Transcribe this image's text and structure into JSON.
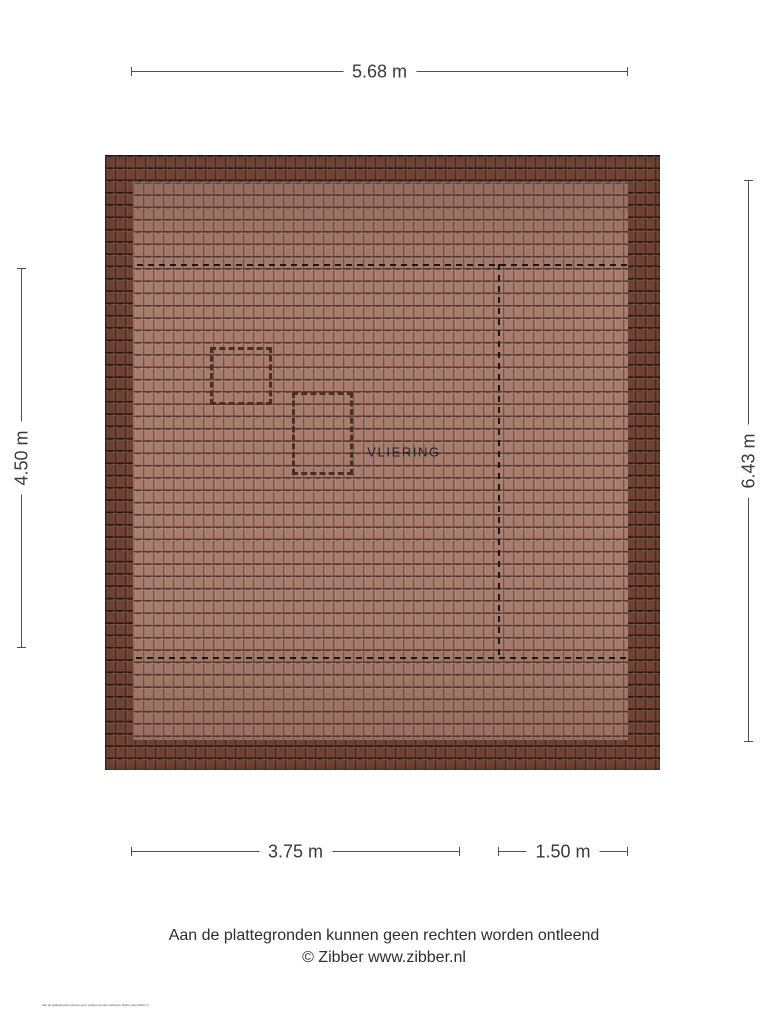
{
  "plan": {
    "room_label": "VLIERING",
    "dimensions": {
      "top": "5.68 m",
      "left": "4.50 m",
      "right": "6.43 m",
      "bottom_left": "3.75 m",
      "bottom_right": "1.50 m"
    },
    "colors": {
      "tile_inner": "#a87d70",
      "tile_border": "#6e4336",
      "guide_dash": "#1c1712",
      "square_dash": "#4e2d22",
      "dimension_line": "#4f4f4f",
      "text": "#2e2e2e"
    }
  },
  "footer": {
    "disclaimer": "Aan de plattegronden kunnen geen rechten worden ontleend",
    "credit": "© Zibber www.zibber.nl",
    "micro_note": "Aan de plattegronden kunnen geen rechten worden ontleend | Zibber www.zibber.nl"
  }
}
